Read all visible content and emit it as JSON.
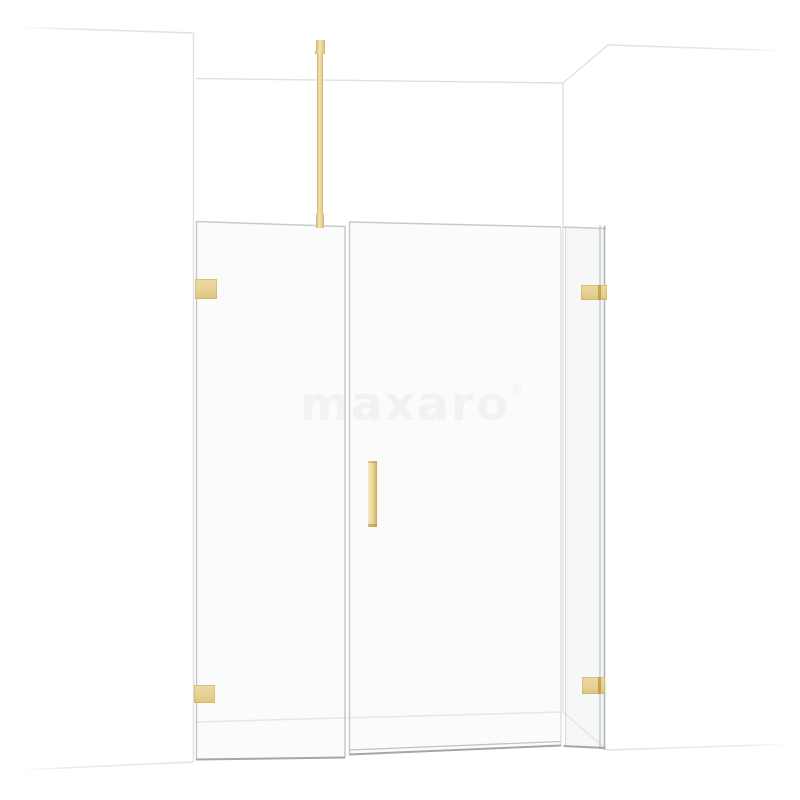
{
  "watermark": {
    "text": "maxaro",
    "registered_mark": "®"
  },
  "colors": {
    "background": "#ffffff",
    "gold_light": "#f2e6b4",
    "gold": "#e7d194",
    "gold_dark": "#d2b469",
    "gold_deep": "#b8953e",
    "line_wall": "#e0e0e0",
    "line_floor": "#e7e7e7",
    "glass_edge": "#c6cacc",
    "glass_edge_dark": "#a2a8aa",
    "watermark_color": "#f1f1f1"
  }
}
